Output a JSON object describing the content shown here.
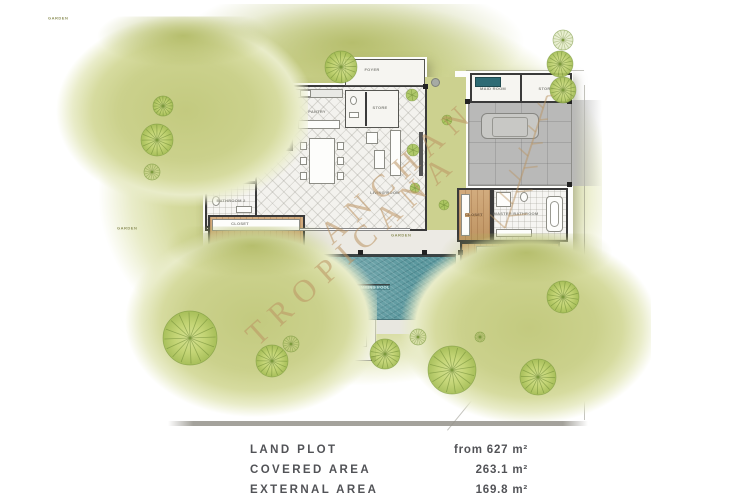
{
  "watermark": {
    "line1": "ANCHAN",
    "line2": "TROPICANA",
    "color": "#bc9463"
  },
  "plan": {
    "labels": [
      {
        "text": "BEDROOM 3",
        "x": 249,
        "y": 112,
        "variant": ""
      },
      {
        "text": "BATHROOM 3",
        "x": 231,
        "y": 163,
        "variant": ""
      },
      {
        "text": "BATHROOM 2",
        "x": 231,
        "y": 201,
        "variant": ""
      },
      {
        "text": "CLOSET",
        "x": 240,
        "y": 224,
        "variant": ""
      },
      {
        "text": "BEDROOM 2",
        "x": 236,
        "y": 268,
        "variant": ""
      },
      {
        "text": "PANTRY",
        "x": 317,
        "y": 112,
        "variant": ""
      },
      {
        "text": "FOYER",
        "x": 372,
        "y": 70,
        "variant": ""
      },
      {
        "text": "STORE",
        "x": 380,
        "y": 108,
        "variant": ""
      },
      {
        "text": "LIVING ROOM",
        "x": 385,
        "y": 193,
        "variant": ""
      },
      {
        "text": "MAID ROOM",
        "x": 493,
        "y": 89,
        "variant": ""
      },
      {
        "text": "STORE",
        "x": 546,
        "y": 89,
        "variant": ""
      },
      {
        "text": "CLOSET",
        "x": 474,
        "y": 215,
        "variant": "wood"
      },
      {
        "text": "MASTER BATHROOM",
        "x": 516,
        "y": 214,
        "variant": ""
      },
      {
        "text": "MASTER BEDROOM",
        "x": 505,
        "y": 263,
        "variant": ""
      },
      {
        "text": "SWIMMING POOL",
        "x": 371,
        "y": 287,
        "variant": "pool"
      },
      {
        "text": "GARDEN",
        "x": 178,
        "y": 124,
        "variant": "garden"
      },
      {
        "text": "GARDEN",
        "x": 247,
        "y": 334,
        "variant": "garden"
      },
      {
        "text": "GARDEN",
        "x": 521,
        "y": 341,
        "variant": "garden"
      }
    ],
    "trees": [
      {
        "x": 163,
        "y": 106,
        "r": 10,
        "sketch": false
      },
      {
        "x": 157,
        "y": 140,
        "r": 16,
        "sketch": false
      },
      {
        "x": 152,
        "y": 172,
        "r": 8,
        "sketch": true
      },
      {
        "x": 341,
        "y": 67,
        "r": 16,
        "sketch": false
      },
      {
        "x": 563,
        "y": 40,
        "r": 10,
        "sketch": true
      },
      {
        "x": 560,
        "y": 64,
        "r": 13,
        "sketch": false
      },
      {
        "x": 563,
        "y": 90,
        "r": 13,
        "sketch": false
      },
      {
        "x": 190,
        "y": 338,
        "r": 27,
        "sketch": false
      },
      {
        "x": 272,
        "y": 361,
        "r": 16,
        "sketch": false
      },
      {
        "x": 291,
        "y": 344,
        "r": 8,
        "sketch": true
      },
      {
        "x": 385,
        "y": 354,
        "r": 15,
        "sketch": false
      },
      {
        "x": 418,
        "y": 337,
        "r": 8,
        "sketch": true
      },
      {
        "x": 452,
        "y": 370,
        "r": 24,
        "sketch": false
      },
      {
        "x": 538,
        "y": 377,
        "r": 18,
        "sketch": false
      },
      {
        "x": 563,
        "y": 297,
        "r": 16,
        "sketch": false
      },
      {
        "x": 480,
        "y": 337,
        "r": 5,
        "sketch": true
      }
    ],
    "bushes": [
      {
        "x": 412,
        "y": 95,
        "r": 6
      },
      {
        "x": 413,
        "y": 150,
        "r": 6
      },
      {
        "x": 415,
        "y": 188,
        "r": 5
      },
      {
        "x": 447,
        "y": 120,
        "r": 5
      },
      {
        "x": 444,
        "y": 205,
        "r": 5
      }
    ]
  },
  "info": {
    "rows": [
      {
        "label": "LAND PLOT",
        "value": "from 627 m²"
      },
      {
        "label": "COVERED AREA",
        "value": "263.1 m²"
      },
      {
        "label": "EXTERNAL AREA",
        "value": "169.8 m²"
      }
    ]
  },
  "colors": {
    "garden": "#c8ce8a",
    "pool_water": "#5b989e",
    "wood_floor": "#cb9e69",
    "wall": "#3a3a3a",
    "watermark": "#bc9463",
    "info_text": "#525357"
  }
}
